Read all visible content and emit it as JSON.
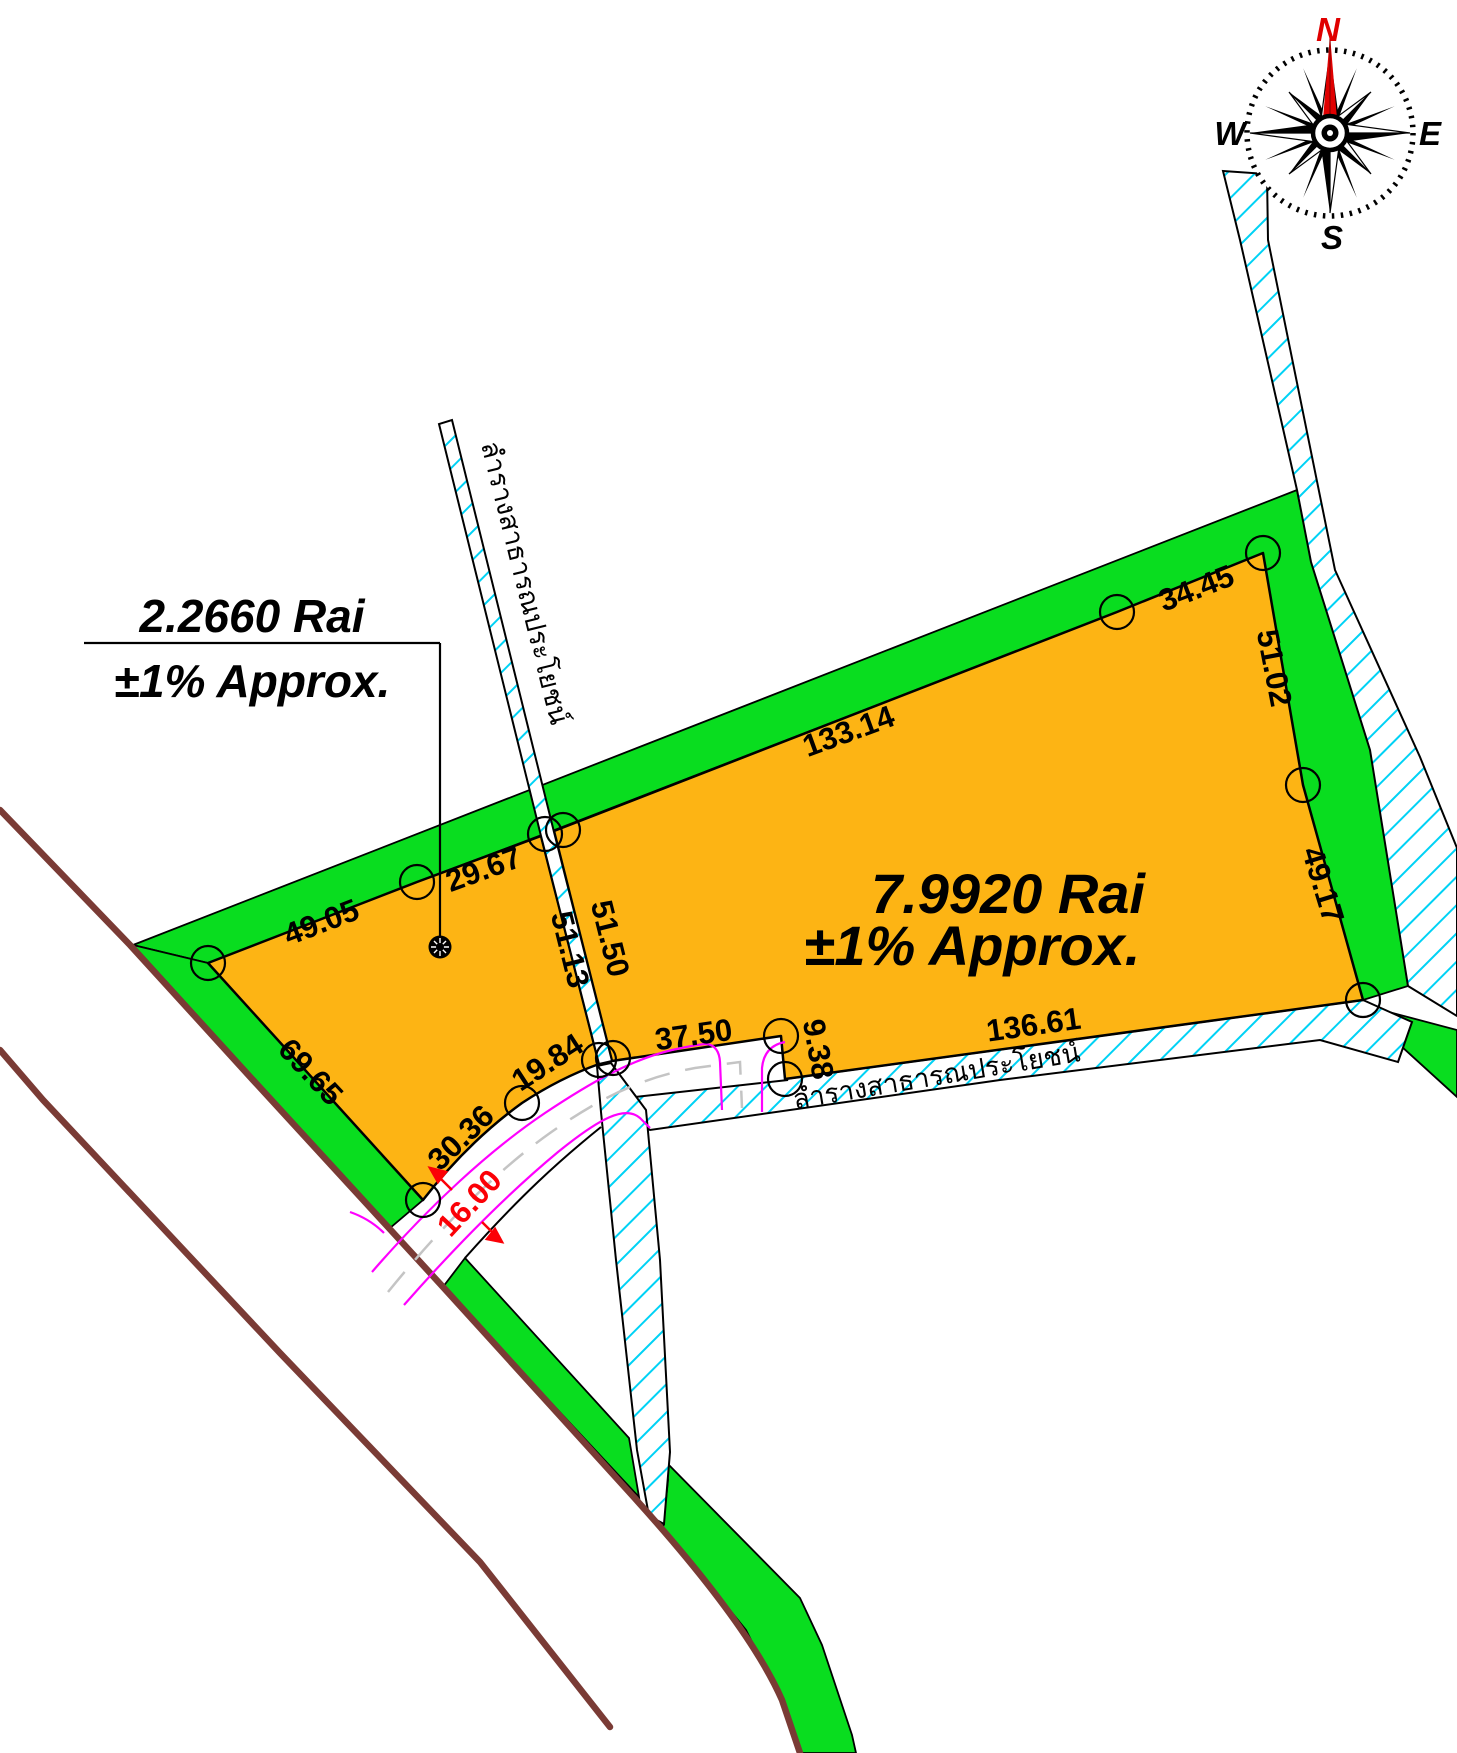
{
  "map_title": "Cadastral survey plan of two land parcels",
  "parcel_small": {
    "area": "2.2660 Rai",
    "tol": "±1% Approx."
  },
  "parcel_big": {
    "area": "7.9920 Rai",
    "tol": "±1% Approx."
  },
  "canal_label": "ลำรางสาธารณประโยชน์",
  "dims": {
    "d49_05": "49.05",
    "d29_67": "29.67",
    "d133_14": "133.14",
    "d34_45": "34.45",
    "d51_02": "51.02",
    "d49_17": "49.17",
    "d51_50": "51.50",
    "d51_13": "51.13",
    "d37_50": "37.50",
    "d9_38": "9.38",
    "d136_61": "136.61",
    "d19_84": "19.84",
    "d30_36": "30.36",
    "d69_65": "69.65"
  },
  "road": {
    "width_label": "16.00"
  },
  "compass": {
    "north": "N",
    "east": "E",
    "south": "S",
    "west": "W"
  },
  "colors": {
    "parcel_fill": "#FDB414",
    "buffer_green": "#09DD1F",
    "canal_hatch_cyan": "#00D2F5",
    "road_line_brown": "#7A3B35",
    "curb_magenta": "#FF00FF",
    "dimension_red": "#FB0006",
    "outline_black": "#000000"
  }
}
